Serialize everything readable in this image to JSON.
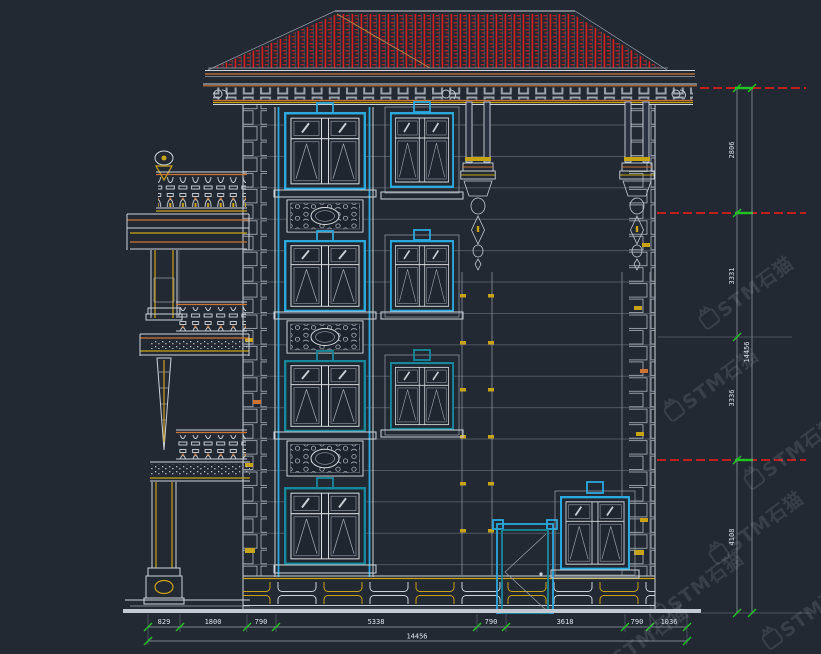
{
  "drawing": {
    "type": "building-side-elevation",
    "background": "#232933"
  },
  "watermark": {
    "text": "STM石猫",
    "logo": "cat-logo"
  },
  "dimensions": {
    "bottom": {
      "labels": [
        "829",
        "1800",
        "790",
        "5338",
        "790",
        "3618",
        "790",
        "1036"
      ],
      "total": "14456"
    },
    "right": {
      "labels": [
        "2806",
        "3331",
        "3336",
        "4108"
      ],
      "total": "14456"
    }
  },
  "colors": {
    "background": "#232933",
    "line_white": "#cdd3da",
    "line_grey": "#98a1ac",
    "line_muted": "#57616e",
    "window_cyan": "#2aa9dc",
    "window_teal": "#17889c",
    "trim_yellow": "#c8a415",
    "trim_orange": "#cd7432",
    "roof_red": "#d81e1e",
    "dim_green": "#21c421",
    "dim_red": "#d81e1e",
    "dim_text": "#dde2e8"
  }
}
